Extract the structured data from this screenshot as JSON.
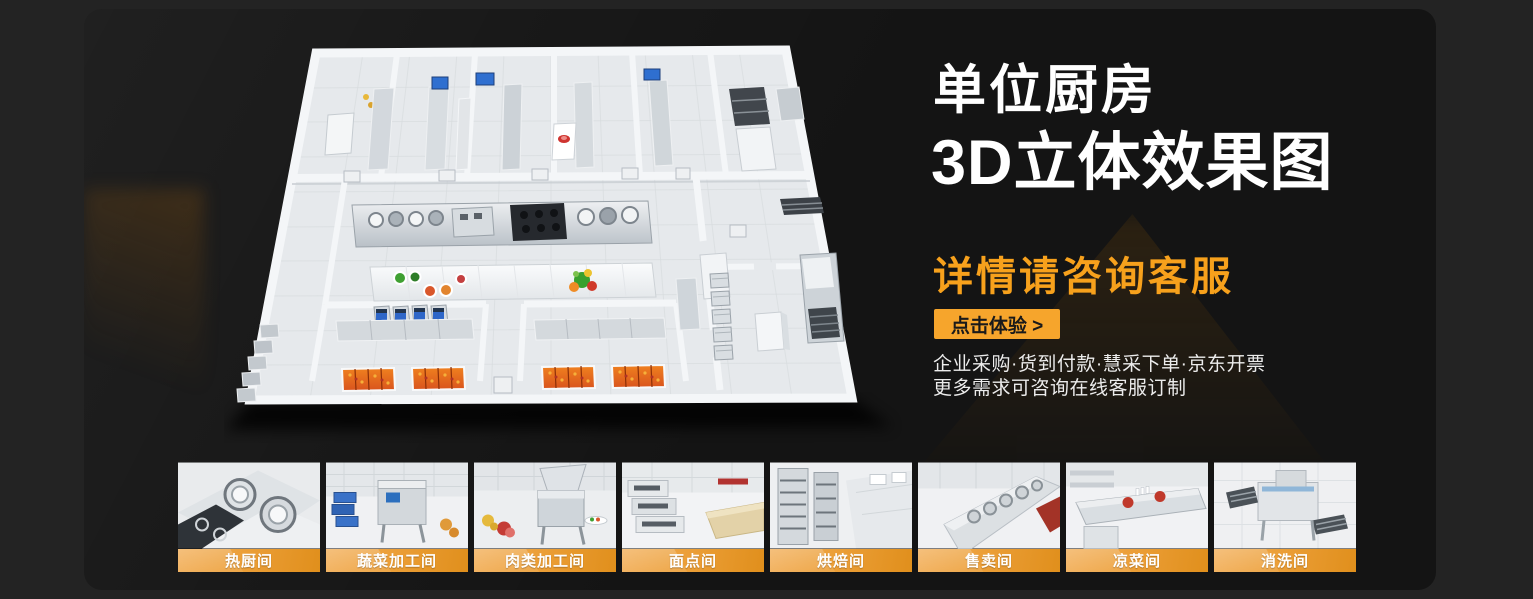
{
  "banner": {
    "title_line1": "单位厨房",
    "title_line2": "3D立体效果图",
    "subtitle": "详情请咨询客服",
    "cta": "点击体验 >",
    "info_line1": "企业采购·货到付款·慧采下单·京东开票",
    "info_line2": "更多需求可咨询在线客服订制"
  },
  "colors": {
    "accent_orange": "#F6A52C",
    "subtitle_orange": "#F7A11C",
    "page_bg": "#232323",
    "banner_bg": "#141414",
    "label_gradient_start": "#F2AE57",
    "label_gradient_end": "#E08F1C"
  },
  "gallery": {
    "items": [
      {
        "label": "热厨间"
      },
      {
        "label": "蔬菜加工间"
      },
      {
        "label": "肉类加工间"
      },
      {
        "label": "面点间"
      },
      {
        "label": "烘焙间"
      },
      {
        "label": "售卖间"
      },
      {
        "label": "凉菜间"
      },
      {
        "label": "消洗间"
      }
    ]
  }
}
